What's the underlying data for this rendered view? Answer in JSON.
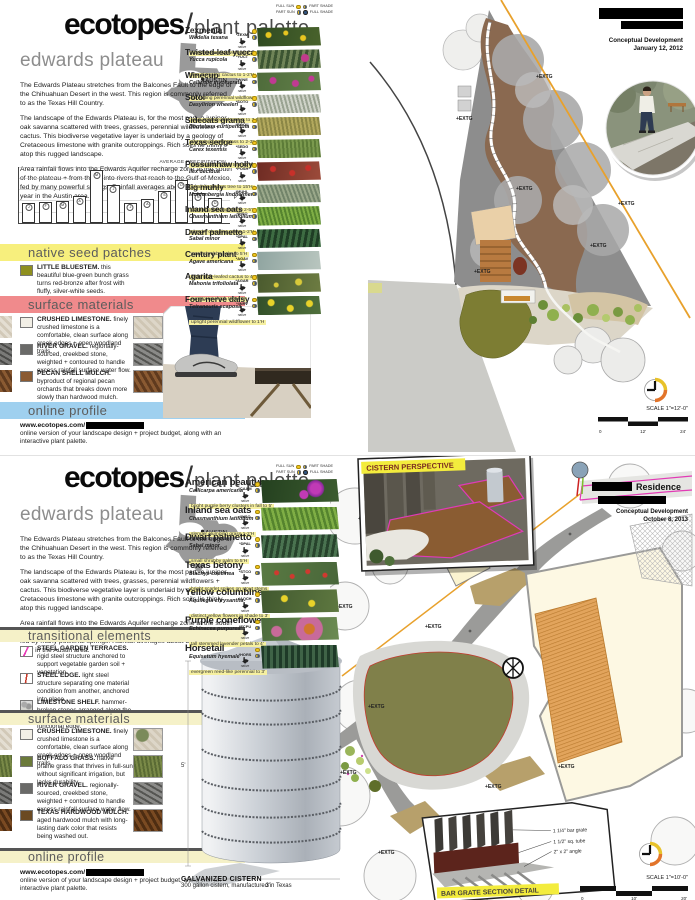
{
  "chart_data": {
    "type": "bar",
    "title": "AVERAGE PRECIPITATION",
    "right_axis_label": "P",
    "categories": [
      "J",
      "F",
      "M",
      "A",
      "M",
      "J",
      "J",
      "A",
      "S",
      "O",
      "N",
      "D"
    ],
    "values": [
      1.8,
      1.9,
      2.0,
      2.4,
      4.7,
      3.4,
      1.8,
      2.1,
      2.9,
      3.8,
      2.7,
      2.2
    ],
    "ylim": [
      0,
      5
    ],
    "points": [
      {
        "m": "J",
        "v": 1.8
      },
      {
        "m": "F",
        "v": 1.9
      },
      {
        "m": "M",
        "v": 2.0
      },
      {
        "m": "A",
        "v": 2.4
      },
      {
        "m": "M",
        "v": 4.7
      },
      {
        "m": "J",
        "v": 3.4
      },
      {
        "m": "J",
        "v": 1.8
      },
      {
        "m": "A",
        "v": 2.1
      },
      {
        "m": "S",
        "v": 2.9
      },
      {
        "m": "O",
        "v": 3.8
      },
      {
        "m": "N",
        "v": 2.7
      },
      {
        "m": "D",
        "v": 2.2
      }
    ]
  },
  "boards": [
    {
      "header": {
        "brand": "ecotopes",
        "slash": "/",
        "subtitle": "plant palette"
      },
      "meta": {
        "phase": "Conceptual Development",
        "date": "January 12, 2012"
      },
      "region": {
        "title": "edwards plateau",
        "map_label": "AUSTIN",
        "paragraphs": [
          "The Edwards Plateau stretches from the Balcones Fault to the edge of the Chihuahuan Desert in the west. This region is commonly referred to as the Texas Hill Country.",
          "The landscape of the Edwards Plateau is, for the most part, a juniper-oak savanna scattered with trees, grasses, perennial wildflowers + cactus. This biodiverse vegetative layer is underlaid by a geology of Cretaceous limestone with granite outcroppings.  Rich soils lie thinly atop this rugged landscape.",
          "Area rainfall flows into the Edwards Aquifer recharge zone at the south of the plateau + from there, into rivers that reach to the Gulf of Mexico, fed by many powerful springs. Rainfall averages about 32 inches per year in the Austin area."
        ]
      },
      "legend": {
        "full_sun": "FULL SUN",
        "part_shade": "PART SHADE",
        "part_sun": "PART SUN",
        "full_shade": "FULL SHADE"
      },
      "plants": [
        {
          "name": "Zexmenia",
          "botanical": "Wedelia texana",
          "note": "woody perennial wildflower to 1-2'H",
          "code": "*ZEXM",
          "native": "native",
          "photo": "radial-gradient(circle at 18% 40%,#e8c520 2.5px,transparent 3.5px),radial-gradient(circle at 72% 55%,#e8c520 2.5px,transparent 3.5px),radial-gradient(circle at 45% 30%,#e8c520 2px,transparent 3px),linear-gradient(100deg,#2f4a22,#49632c)"
        },
        {
          "name": "Twisted-leaf yucca",
          "botanical": "Yucca rupicola",
          "note": "low, clumping cactus to 1-2'H",
          "code": "*YUCT",
          "native": "native",
          "photo": "radial-gradient(circle at 75% 45%,#c23a8c 3.5px,transparent 4.5px),repeating-linear-gradient(100deg,#3c5532 0 3px,#6f8457 3px 6px)"
        },
        {
          "name": "Winecup",
          "botanical": "Callirhoe involucrata",
          "note": "spreading perennial wildflower to 1'H",
          "code": "*WINE",
          "native": "native",
          "photo": "radial-gradient(circle at 25% 45%,#c03a92 3px,transparent 4px),radial-gradient(circle at 60% 60%,#c03a92 3px,transparent 4px),radial-gradient(circle at 85% 35%,#c03a92 2.5px,transparent 3.5px),linear-gradient(100deg,#4e6b3a,#63814a)"
        },
        {
          "name": "Sotol",
          "botanical": "Dasylirion wheeleri",
          "note": "long, spiny-leafed cactus to 3-5'H",
          "code": "*SOTO",
          "native": "native",
          "photo": "repeating-linear-gradient(75deg,#cfd3c8 0 2px,#9aa392 2px 4px)"
        },
        {
          "name": "Sideoats grama",
          "botanical": "Bouteloua curtipendula",
          "note": "clumping bunch grass to 2-3'H",
          "code": "*BOCU",
          "native": "native",
          "photo": "repeating-linear-gradient(80deg,#b3a95e 0 2px,#8c8746 2px 4px)"
        },
        {
          "name": "Texas sedge",
          "botanical": "Carex texensis",
          "note": "fine-textured grass to 6-10\"H",
          "code": "*SEDG",
          "native": "native",
          "photo": "repeating-linear-gradient(85deg,#7b9a4e 0 2px,#5d7c38 2px 4px)"
        },
        {
          "name": "Possumhaw holly",
          "botanical": "Ilex decidua",
          "note": "small deciduous tree to 15'H",
          "code": "*POSH",
          "native": "native",
          "photo": "radial-gradient(circle at 25% 40%,#c8302a 2.5px,transparent 3.5px),radial-gradient(circle at 55% 60%,#c8302a 2.5px,transparent 3.5px),radial-gradient(circle at 80% 35%,#c8302a 2.5px,transparent 3.5px),linear-gradient(100deg,#6e2b23,#9c4b3a)"
        },
        {
          "name": "Big muhly",
          "botanical": "Muhlenbergia lindheimeri",
          "note": "clumping bunchgrass to 2-5'H",
          "code": "*MUHL",
          "native": "native",
          "photo": "repeating-linear-gradient(70deg,#9aa88a 0 2px,#72846a 2px 4px)"
        },
        {
          "name": "Inland sea oats",
          "botanical": "Chasmanthium latifolium",
          "note": "slender clumping grass 1-2'H",
          "code": "*INSO",
          "native": "native",
          "photo": "repeating-linear-gradient(75deg,#7fae45 0 2px,#55842e 2px 4px)"
        },
        {
          "name": "Dwarf palmetto",
          "botanical": "Sabal minor",
          "note": "small shrubby palm to 5'H",
          "code": "*DPAL",
          "native": "native",
          "photo": "repeating-linear-gradient(100deg,#1f3d25 0 3px,#3d6b42 3px 6px)"
        },
        {
          "name": "Century plant",
          "botanical": "Agave americana",
          "note": "large gray-leafed cactus to 4-6'H",
          "code": "*AGAV",
          "native": "native",
          "photo": "linear-gradient(100deg,#8fa4a0,#b9c6bf)"
        },
        {
          "name": "Agarita",
          "botanical": "Mahonia trifoliolata",
          "note": "evergreen shrub to 3-6'H",
          "code": "*AGAR",
          "native": "native",
          "photo": "radial-gradient(circle at 65% 45%,#d8c93a 3px,transparent 4px),radial-gradient(circle at 30% 60%,#d8c93a 2px,transparent 3px),linear-gradient(100deg,#4a5a2e,#6d7c42)"
        },
        {
          "name": "Four-nerve daisy",
          "botanical": "Tetraneuris scaposa",
          "note": "upright perennial wildflower to 1'H",
          "code": "*4NRV",
          "native": "native",
          "photo": "radial-gradient(circle at 22% 35%,#e8d22a 3px,transparent 4px),radial-gradient(circle at 52% 65%,#e8d22a 3px,transparent 4px),radial-gradient(circle at 82% 40%,#e8d22a 3px,transparent 4px),linear-gradient(100deg,#33502a,#50703c)"
        }
      ],
      "seed_section": {
        "title": "native seed patches",
        "color": "#f7ef7d",
        "items": [
          {
            "term": "LITTLE BLUESTEM.",
            "desc": "this beautiful blue-green bunch grass turns red-bronze after frost with fluffy, silver-white seeds.",
            "swatch": "#8f901f"
          }
        ]
      },
      "materials_section": {
        "title": "surface materials",
        "color": "#f08a8c",
        "items": [
          {
            "term": "CRUSHED LIMESTONE.",
            "desc": "finely crushed limestone is a comfortable, clean surface along creek edges + open woodland trails.",
            "swatch": "#f2efe6",
            "photo": "repeating-linear-gradient(45deg,#ddd6c8 0 3px,#cfc6b4 3px 6px)",
            "bleed": "repeating-linear-gradient(45deg,#e4ded2 0 3px,#d2c9b8 3px 6px)"
          },
          {
            "term": "RIVER GRAVEL.",
            "desc": "regionally-sourced, creekbed stone, weighted + contoured to handle excess rainfall surface water flow.",
            "swatch": "#6a6a68",
            "photo": "repeating-linear-gradient(30deg,#8a8a88 0 3px,#555552 3px 5px)",
            "bleed": "repeating-linear-gradient(30deg,#7a7a78 0 3px,#4a4a48 3px 5px)"
          },
          {
            "term": "PECAN SHELL MULCH.",
            "desc": "byproduct of regional pecan orchards that breaks down more slowly than hardwood mulch.",
            "swatch": "#8a5a32",
            "photo": "repeating-linear-gradient(60deg,#8a5a32 0 3px,#5f3a1e 3px 6px)",
            "bleed": "repeating-linear-gradient(60deg,#8a5a32 0 3px,#5f3a1e 3px 6px)"
          }
        ]
      },
      "online_section": {
        "title": "online profile",
        "color": "#9fd0ef",
        "url": "www.ecotopes.com/",
        "desc": "online version of your landscape design + project budget, along with an interactive plant palette."
      },
      "plan": {
        "scale_label": "SCALE 1\"=12'-0\"",
        "ticks": [
          "0",
          "12'",
          "24'"
        ],
        "extg_label": "+EXTG"
      }
    },
    {
      "header": {
        "brand": "ecotopes",
        "slash": "/",
        "subtitle": "plant palette"
      },
      "meta": {
        "client": "Residence",
        "phase": "Conceptual Development",
        "date": "October 8, 2013"
      },
      "region": {
        "title": "edwards plateau",
        "map_label": "AUSTIN",
        "paragraphs": [
          "The Edwards Plateau stretches from the Balcones Fault to the edge of the Chihuahuan Desert in the west. This region is commonly referred to as the Texas Hill Country.",
          "The landscape of the Edwards Plateau is, for the most part, a juniper-oak savanna scattered with trees, grasses, perennial wildflowers + cactus. This biodiverse vegetative layer is underlaid by a geology of Cretaceous limestone with granite outcroppings.  Rich soils lie thinly atop this rugged landscape.",
          "Area rainfall flows into the Edwards Aquifer recharge zone at the south of the plateau + from there, into rivers that reach to the Gulf of Mexico, fed by many powerful springs. Rainfall averages about 32 inches per year in the Austin area."
        ]
      },
      "legend": {
        "full_sun": "FULL SUN",
        "part_shade": "PART SHADE",
        "part_sun": "PART SUN",
        "full_shade": "FULL SHADE"
      },
      "plants": [
        {
          "name": "American beautyberry",
          "botanical": "Callicarpa americana",
          "note": "bright purple berry clusters in fall to 5'",
          "code": "*CAAM",
          "native": "native",
          "photo": "radial-gradient(circle at 70% 40%,#c03ab5 5px,#8a2a9a 8px,transparent 9px),radial-gradient(circle at 55% 65%,#c03ab5 4px,transparent 5px),linear-gradient(100deg,#24401f,#3c5c30)"
        },
        {
          "name": "Inland sea oats",
          "botanical": "Chasmanthium latifolium",
          "note": "slender clumping grass 1-2'H",
          "code": "*INSO",
          "native": "native",
          "photo": "repeating-linear-gradient(75deg,#7fae45 0 2.5px,#55842e 2.5px 5px)"
        },
        {
          "name": "Dwarf palmetto",
          "botanical": "Sabal minor",
          "note": "small shrubby palm to 5'H",
          "code": "*DPAL",
          "native": "native",
          "photo": "repeating-linear-gradient(100deg,#27432c 0 3px,#4a7350 3px 6px)"
        },
        {
          "name": "Texas betony",
          "botanical": "Stachys coccinea",
          "note": "bright scarlet spikes on stout stems",
          "code": "*STCO",
          "native": "native",
          "photo": "radial-gradient(circle at 20% 45%,#d0392f 2px,transparent 3px),radial-gradient(circle at 40% 60%,#d0392f 2px,transparent 3px),radial-gradient(circle at 60% 40%,#d0392f 2px,transparent 3px),radial-gradient(circle at 82% 55%,#d0392f 2px,transparent 3px),linear-gradient(100deg,#5a7a42,#48663a)"
        },
        {
          "name": "Yellow columbine",
          "botanical": "Aquilegia chrysantha",
          "note": "distinct yellow flowers in shade to 3'",
          "code": "*AQCH",
          "native": "native",
          "photo": "radial-gradient(circle at 30% 40%,#e8d22a 3px,transparent 4px),radial-gradient(circle at 65% 60%,#e8d22a 3px,transparent 4px),linear-gradient(100deg,#41582f,#5e7840)"
        },
        {
          "name": "Purple coneflower",
          "botanical": "Echinacea purpurea",
          "note": "tall stemmed lavender petals to 4'",
          "code": "*ECPU",
          "native": "native",
          "photo": "radial-gradient(circle at 62% 50%,#d1762c 5px,#c86a9a 6px 13px,transparent 14px),radial-gradient(circle at 20% 60%,#c86a9a 5px,transparent 6px),linear-gradient(100deg,#4c6b3c,#6c8b52)"
        },
        {
          "name": "Horsetail",
          "botanical": "Equisetum hyemale",
          "note": "evergreen reed-like perennial to 3'",
          "code": "*HORS",
          "native": "native",
          "photo": "repeating-linear-gradient(90deg,#1e3a28 0 3px,#3f6347 3px 6px)"
        }
      ],
      "transitional_section": {
        "title": "transitional elements",
        "items": [
          {
            "term": "STEEL GARDEN TERRACES.",
            "desc": "rigid steel structure anchored to support vegetable garden soil + vegetation.",
            "swatch": "linear-gradient(115deg,#fff 40%,#e83db8 40% 52%,#fff 52%)"
          },
          {
            "term": "STEEL EDGE.",
            "desc": "light steel structure separating one material condition from another, anchored into place.",
            "swatch": "linear-gradient(100deg,#fff 42%,#c83a2a 42% 54%,#fff 54%)"
          },
          {
            "term": "LIMESTONE SHELF.",
            "desc": "hammer-broken stones arranged along the dry creek bank for a naturally-functional edge.",
            "swatch": "radial-gradient(circle at 30% 40%,#aaa 2.5px,transparent 3.5px),radial-gradient(circle at 70% 60%,#999 2.5px,transparent 3.5px),linear-gradient(#ddd,#d2d2cc)"
          }
        ]
      },
      "materials_section": {
        "title": "surface materials",
        "items": [
          {
            "term": "CRUSHED LIMESTONE.",
            "desc": "finely crushed limestone is a comfortable, clean surface along creek edges + open woodland trails.",
            "swatch": "#f2efe6",
            "photo": "radial-gradient(circle at 30% 30%,#7a8a5a 6px,transparent 7px),repeating-linear-gradient(45deg,#ddd6c8 0 3px,#cfc6b4 3px 6px)",
            "bleed": "repeating-linear-gradient(45deg,#e4ded2 0 3px,#d2c9b8 3px 6px)"
          },
          {
            "term": "BUFFALO GRASS.",
            "desc": "native prairie grass that thrives in full-sun without significant irrigation, but lacks durability.",
            "swatch": "#6b7a3a",
            "photo": "repeating-linear-gradient(80deg,#7a8a48 0 2px,#5a6b34 2px 4px)",
            "bleed": "repeating-linear-gradient(80deg,#7a8a48 0 2px,#5a6b34 2px 4px)"
          },
          {
            "term": "RIVER GRAVEL.",
            "desc": "regionally-sourced, creekbed stone, weighted + contoured to handle excess rainfall surface water flow.",
            "swatch": "#6a6a68",
            "photo": "repeating-linear-gradient(30deg,#8a8a88 0 3px,#555552 3px 5px)",
            "bleed": "repeating-linear-gradient(30deg,#7a7a78 0 3px,#4a4a48 3px 5px)"
          },
          {
            "term": "TEXAS HARDWOOD MULCH.",
            "desc": "aged hardwood mulch with long-lasting dark color that resists being washed out.",
            "swatch": "#6b4a22",
            "photo": "repeating-linear-gradient(60deg,#7a4a22 0 3px,#4e2d12 3px 6px)",
            "bleed": "repeating-linear-gradient(60deg,#7a4a22 0 3px,#4e2d12 3px 6px)"
          }
        ]
      },
      "online_section": {
        "title": "online profile",
        "url": "www.ecotopes.com/",
        "desc": "online version of your landscape design + project budget, along with an interactive plant palette."
      },
      "cistern_label": "CISTERN PERSPECTIVE",
      "cistern_fig": {
        "title": "GALVANIZED CISTERN",
        "caption": "300 gallon cistern, manufactured in Texas",
        "height_dim": "5'",
        "width_dim": "3'"
      },
      "bar_grate": {
        "title": "BAR GRATE SECTION DETAIL",
        "annotations": [
          "1 1/4\" bar grate",
          "1 1/2\" sq. tube",
          "2\" x 2\" angle"
        ]
      },
      "plan": {
        "scale_label": "SCALE 1\"=10'-0\"",
        "ticks": [
          "0",
          "10'",
          "20'"
        ],
        "extg_label": "+EXTG"
      }
    }
  ]
}
